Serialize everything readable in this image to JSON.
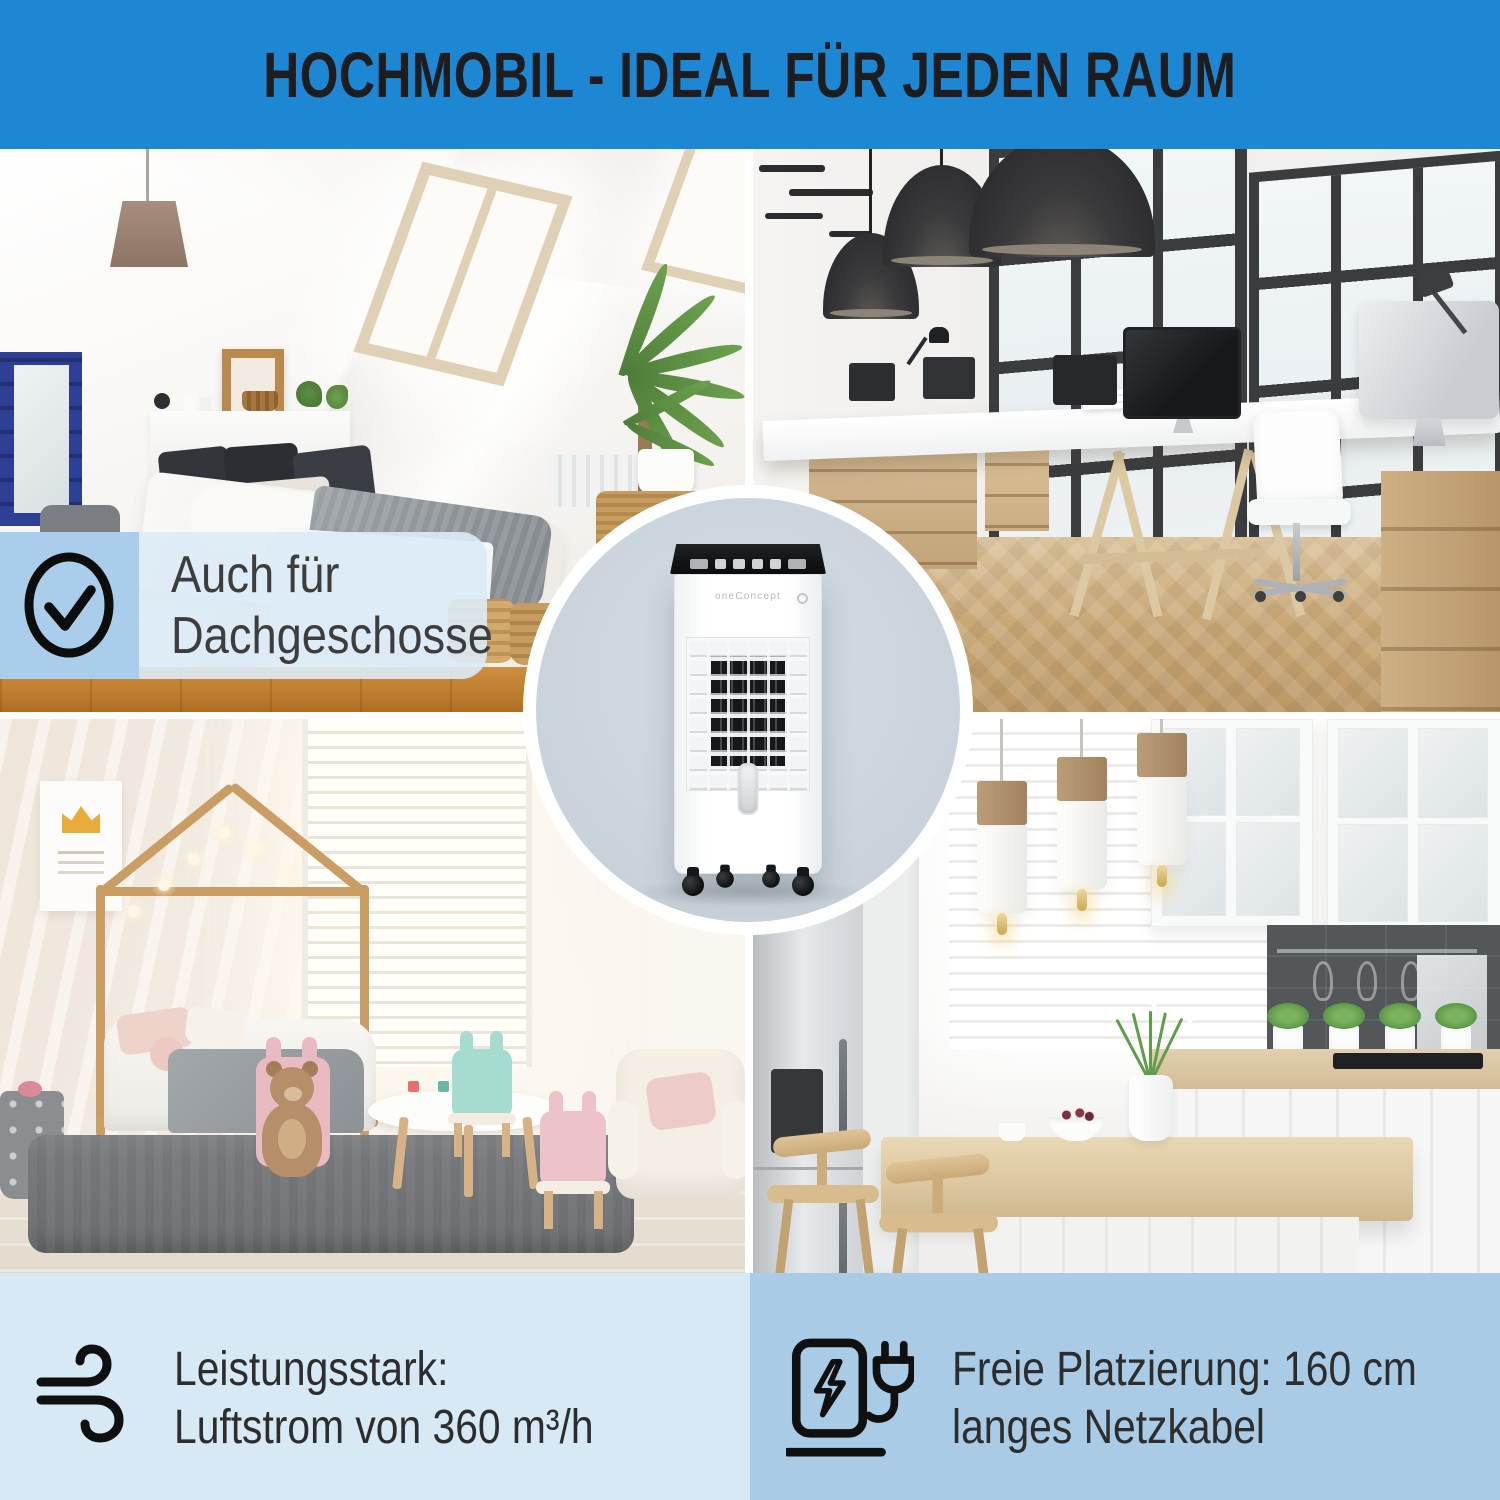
{
  "banner": {
    "title": "HOCHMOBIL - IDEAL FÜR JEDEN RAUM",
    "background_color": "#1d87d3",
    "text_color": "#1d1d1f"
  },
  "overlay_badge": {
    "icon": "check-circle-icon",
    "line1": "Auch für",
    "line2": "Dachgeschosse",
    "square_color": "#a9cdea",
    "panel_color": "#dbebf7"
  },
  "hero": {
    "brand": "oneConcept",
    "product": "mobile-air-cooler-on-casters",
    "circle_color": "#ced6de"
  },
  "photos": [
    {
      "name": "attic-bedroom"
    },
    {
      "name": "modern-office"
    },
    {
      "name": "kids-room"
    },
    {
      "name": "kitchen"
    }
  ],
  "features": [
    {
      "icon": "wind-icon",
      "line1": "Leistungsstark:",
      "line2": "Luftstrom von 360 m³/h",
      "band_color": "#d7e9f5"
    },
    {
      "icon": "charging-cable-icon",
      "line1": "Freie Platzierung: 160 cm",
      "line2": "langes Netzkabel",
      "band_color": "#a9cbe6"
    }
  ],
  "colors": {
    "banner_blue": "#1d87d3",
    "badge_blue": "#a9cdea",
    "band_left_blue": "#d7e9f5",
    "band_right_blue": "#a9cbe6",
    "circle_grey": "#ced6de",
    "text_dark": "#2d2d2d",
    "icon_black": "#101010"
  }
}
